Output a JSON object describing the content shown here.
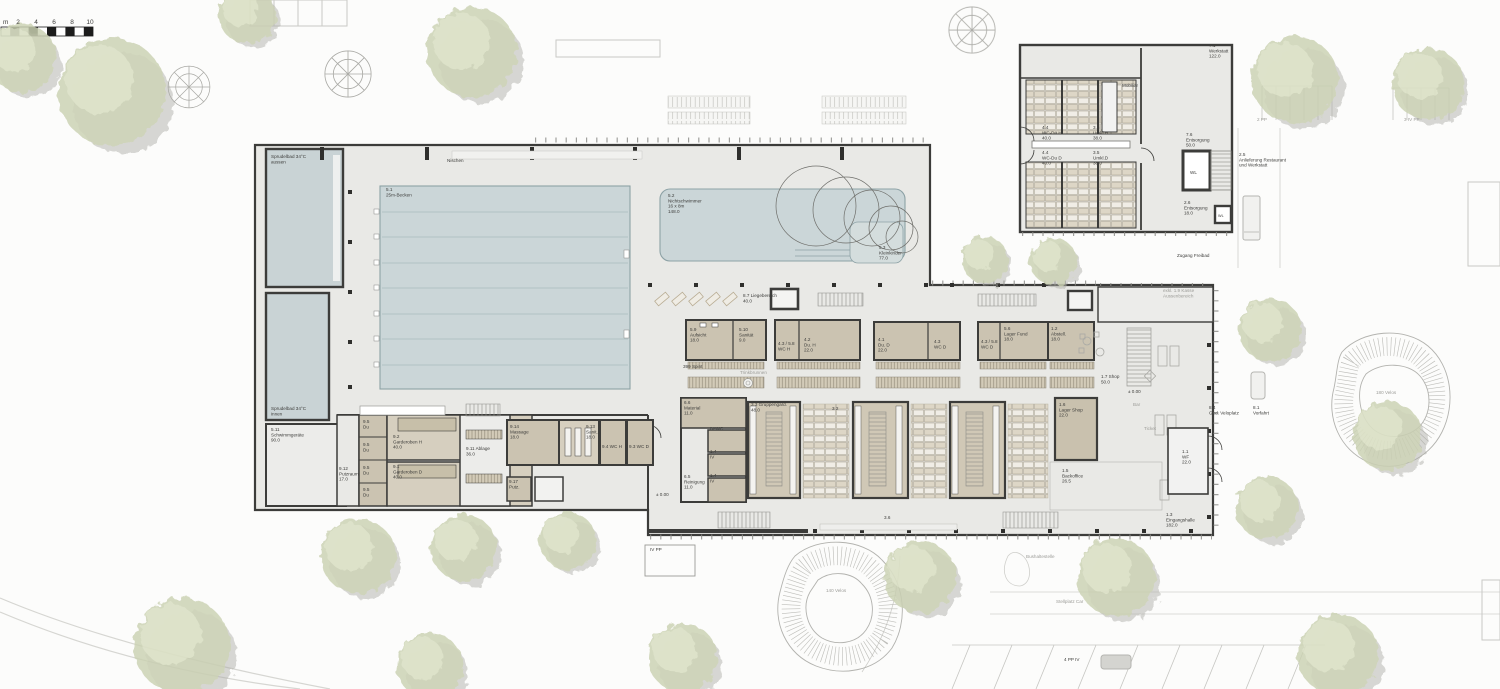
{
  "colors": {
    "dark": "#3d3d3b",
    "gray": "#9c9c98"
  },
  "scalebar": {
    "unit": "m",
    "ticks": [
      "2",
      "4",
      "6",
      "8",
      "10"
    ]
  },
  "labels": [
    {
      "id": "scale-unit",
      "x": 3,
      "y": 24,
      "s": 6.5,
      "lines": [
        "m"
      ]
    },
    {
      "id": "scale-2",
      "x": 18,
      "y": 24,
      "s": 6.5,
      "a": "middle",
      "lines": [
        "2"
      ]
    },
    {
      "id": "scale-4",
      "x": 36,
      "y": 24,
      "s": 6.5,
      "a": "middle",
      "lines": [
        "4"
      ]
    },
    {
      "id": "scale-6",
      "x": 54,
      "y": 24,
      "s": 6.5,
      "a": "middle",
      "lines": [
        "6"
      ]
    },
    {
      "id": "scale-8",
      "x": 72,
      "y": 24,
      "s": 6.5,
      "a": "middle",
      "lines": [
        "8"
      ]
    },
    {
      "id": "scale-10",
      "x": 90,
      "y": 24,
      "s": 6.5,
      "a": "middle",
      "lines": [
        "10"
      ]
    },
    {
      "id": "sprudelbad-aussen",
      "x": 271,
      "y": 158,
      "lines": [
        "Sprudelbad 34°C",
        "aussen"
      ]
    },
    {
      "id": "nischen",
      "x": 447,
      "y": 162,
      "lines": [
        "Nischen"
      ]
    },
    {
      "id": "becken-25m",
      "x": 386,
      "y": 191,
      "lines": [
        "5.1",
        "25m-Becken"
      ]
    },
    {
      "id": "nichtschwimmer",
      "x": 668,
      "y": 197,
      "lines": [
        "5.2",
        "Nichtschwimmer",
        "16 x 8m",
        "148.0"
      ]
    },
    {
      "id": "kleinkinder",
      "x": 879,
      "y": 249,
      "lines": [
        "5.3",
        "Kleinkinder",
        "77.0"
      ]
    },
    {
      "id": "sprudelbad-innen",
      "x": 271,
      "y": 410,
      "lines": [
        "Sprudelbad 34°C",
        "innen"
      ]
    },
    {
      "id": "schwimmgeraete",
      "x": 271,
      "y": 431,
      "lines": [
        "5.11",
        "Schwimmgeräte",
        "90.0"
      ]
    },
    {
      "id": "liegebereich",
      "x": 743,
      "y": 297,
      "lines": [
        "8.7 Liegebereich",
        "40.0"
      ]
    },
    {
      "id": "aufsicht",
      "x": 690,
      "y": 331,
      "lines": [
        "5.9",
        "Aufsicht",
        "18.0"
      ]
    },
    {
      "id": "sanitaet",
      "x": 739,
      "y": 331,
      "lines": [
        "5.10",
        "Sanität",
        "9.0"
      ]
    },
    {
      "id": "wc-h",
      "x": 778,
      "y": 345,
      "lines": [
        "4.3 / 5.8",
        "WC H"
      ]
    },
    {
      "id": "du-h",
      "x": 804,
      "y": 341,
      "lines": [
        "4.2",
        "Du. H",
        "22.0"
      ]
    },
    {
      "id": "spinde",
      "x": 683,
      "y": 368,
      "lines": [
        "399 Spint"
      ]
    },
    {
      "id": "trinkbrunnen",
      "x": 740,
      "y": 374,
      "c": "gray",
      "lines": [
        "Trinkbrunnen"
      ]
    },
    {
      "id": "du-d",
      "x": 878,
      "y": 341,
      "lines": [
        "4.1",
        "Du. D",
        "22.0"
      ]
    },
    {
      "id": "wc-d-a",
      "x": 934,
      "y": 343,
      "lines": [
        "4.3",
        "WC D"
      ]
    },
    {
      "id": "wc-d-b",
      "x": 981,
      "y": 343,
      "lines": [
        "4.3 / 5.8",
        "WC D"
      ]
    },
    {
      "id": "lager-fund",
      "x": 1004,
      "y": 330,
      "lines": [
        "5.6",
        "Lager Fund",
        "18.0"
      ]
    },
    {
      "id": "abstell",
      "x": 1051,
      "y": 330,
      "lines": [
        "1.2",
        "Abstell.",
        "18.0"
      ]
    },
    {
      "id": "material",
      "x": 684,
      "y": 404,
      "lines": [
        "6.6",
        "Material",
        "11.0"
      ]
    },
    {
      "id": "iv-wc",
      "x": 710,
      "y": 430,
      "lines": [
        "IV-WC"
      ]
    },
    {
      "id": "iv-1",
      "x": 710,
      "y": 453,
      "lines": [
        "1.4",
        "IV"
      ]
    },
    {
      "id": "iv-2",
      "x": 710,
      "y": 477,
      "lines": [
        "1.4",
        "IV"
      ]
    },
    {
      "id": "reinigung",
      "x": 684,
      "y": 478,
      "lines": [
        "6.5",
        "Reinigung",
        "11.0"
      ]
    },
    {
      "id": "gruppengard",
      "x": 751,
      "y": 406,
      "lines": [
        "3.3 Gruppengard.",
        "48.0"
      ]
    },
    {
      "id": "corridor-32",
      "x": 832,
      "y": 410,
      "lines": [
        "3.2"
      ]
    },
    {
      "id": "lager-shop",
      "x": 1059,
      "y": 406,
      "lines": [
        "1.6",
        "Lager Shop",
        "22.0"
      ]
    },
    {
      "id": "backoffice",
      "x": 1062,
      "y": 472,
      "lines": [
        "1.5",
        "Backoffice",
        "26.5"
      ]
    },
    {
      "id": "shop",
      "x": 1101,
      "y": 378,
      "lines": [
        "1.7 Shop",
        "50.0"
      ]
    },
    {
      "id": "level-entry",
      "x": 1128,
      "y": 393,
      "lines": [
        "± 0.00"
      ]
    },
    {
      "id": "bar",
      "x": 1133,
      "y": 406,
      "c": "gray",
      "lines": [
        "Bar"
      ]
    },
    {
      "id": "ticket",
      "x": 1144,
      "y": 430,
      "c": "gray",
      "lines": [
        "Ticket"
      ]
    },
    {
      "id": "wf",
      "x": 1182,
      "y": 453,
      "lines": [
        "1.1",
        "WF",
        "22.0"
      ]
    },
    {
      "id": "eingangshalle",
      "x": 1166,
      "y": 516,
      "lines": [
        "1.3",
        "Eingangshalle",
        "182.0"
      ]
    },
    {
      "id": "level-pool",
      "x": 656,
      "y": 496,
      "lines": [
        "± 0.00"
      ]
    },
    {
      "id": "putzraum",
      "x": 339,
      "y": 470,
      "lines": [
        "9.12",
        "Putzraum",
        "17.0"
      ]
    },
    {
      "id": "du-1",
      "x": 363,
      "y": 423,
      "lines": [
        "9.5",
        "Du"
      ]
    },
    {
      "id": "du-2",
      "x": 363,
      "y": 446,
      "lines": [
        "9.5",
        "Du"
      ]
    },
    {
      "id": "du-3",
      "x": 363,
      "y": 469,
      "lines": [
        "9.5",
        "Du"
      ]
    },
    {
      "id": "du-4",
      "x": 363,
      "y": 491,
      "lines": [
        "9.5",
        "Du"
      ]
    },
    {
      "id": "garderoben-h",
      "x": 393,
      "y": 438,
      "lines": [
        "9.2",
        "Garderoben H",
        "40.0"
      ]
    },
    {
      "id": "garderoben-d",
      "x": 393,
      "y": 468,
      "lines": [
        "9.1",
        "Garderoben D",
        "40.0"
      ]
    },
    {
      "id": "ablage",
      "x": 466,
      "y": 450,
      "lines": [
        "9.11 Ablage",
        "36.0"
      ]
    },
    {
      "id": "massage",
      "x": 510,
      "y": 428,
      "lines": [
        "9.14",
        "Massage",
        "18.0"
      ]
    },
    {
      "id": "raum-913",
      "x": 586,
      "y": 428,
      "lines": [
        "9.13",
        "Sanit.",
        "18.0"
      ]
    },
    {
      "id": "wc-h-9",
      "x": 602,
      "y": 448,
      "lines": [
        "9.4 WC H"
      ]
    },
    {
      "id": "wc-d-9",
      "x": 629,
      "y": 448,
      "lines": [
        "9.3 WC D"
      ]
    },
    {
      "id": "putz-klein",
      "x": 509,
      "y": 483,
      "lines": [
        "9.17",
        "Putz."
      ]
    },
    {
      "id": "werkstatt",
      "x": 1209,
      "y": 47,
      "lines": [
        "7.1",
        "Werkstatt",
        "122.0"
      ]
    },
    {
      "id": "mobiliar",
      "x": 1122,
      "y": 87,
      "lines": [
        "Mobiliar"
      ]
    },
    {
      "id": "wc-du-h",
      "x": 1042,
      "y": 129,
      "lines": [
        "4.4",
        "WC-Du H",
        "40.0"
      ]
    },
    {
      "id": "umkl-h",
      "x": 1093,
      "y": 129,
      "lines": [
        "3.5",
        "Umkl.H",
        "38.0"
      ]
    },
    {
      "id": "wc-du-d",
      "x": 1042,
      "y": 154,
      "lines": [
        "4.4",
        "WC-Du D",
        "40.0"
      ]
    },
    {
      "id": "umkl-d",
      "x": 1093,
      "y": 154,
      "lines": [
        "3.5",
        "Umkl.D",
        "38.0"
      ]
    },
    {
      "id": "entsorgung-76",
      "x": 1186,
      "y": 136,
      "lines": [
        "7.6",
        "Entsorgung",
        "50.0"
      ]
    },
    {
      "id": "wl-1",
      "x": 1190,
      "y": 174,
      "lines": [
        "WL"
      ]
    },
    {
      "id": "entsorgung-26",
      "x": 1184,
      "y": 204,
      "lines": [
        "2.6",
        "Entsorgung",
        "18.0"
      ]
    },
    {
      "id": "wl-2",
      "x": 1218,
      "y": 217,
      "s": 3.8,
      "lines": [
        "WL"
      ]
    },
    {
      "id": "anlieferung",
      "x": 1239,
      "y": 156,
      "lines": [
        "2.5",
        "Anlieferung Restaurant",
        "und Werkstatt"
      ]
    },
    {
      "id": "zugang-freibad",
      "x": 1177,
      "y": 257,
      "lines": [
        "Zugang Freibad"
      ]
    },
    {
      "id": "kasse",
      "x": 1163,
      "y": 292,
      "c": "gray",
      "lines": [
        "exkl. 1.9 Kasse",
        "Aussenbereich"
      ]
    },
    {
      "id": "pp-2",
      "x": 1257,
      "y": 121,
      "c": "gray",
      "lines": [
        "2 PP"
      ]
    },
    {
      "id": "pp-3iv",
      "x": 1404,
      "y": 121,
      "c": "gray",
      "lines": [
        "3 IV PP"
      ]
    },
    {
      "id": "ged-veloplatz",
      "x": 1209,
      "y": 409,
      "lines": [
        "8.4",
        "Ged. Veloplatz"
      ]
    },
    {
      "id": "vorfahrt",
      "x": 1253,
      "y": 409,
      "lines": [
        "8.1",
        "Vorfahrt"
      ]
    },
    {
      "id": "velos-140",
      "x": 826,
      "y": 592,
      "c": "gray",
      "lines": [
        "140 Velos"
      ]
    },
    {
      "id": "velos-180",
      "x": 1376,
      "y": 394,
      "c": "gray",
      "lines": [
        "180 Velos"
      ]
    },
    {
      "id": "stellplatz-car",
      "x": 1056,
      "y": 603,
      "c": "gray",
      "lines": [
        "Stellplatz Car"
      ]
    },
    {
      "id": "bushaltestelle",
      "x": 1026,
      "y": 558,
      "c": "gray",
      "lines": [
        "Bushaltestelle"
      ]
    },
    {
      "id": "iv-pp",
      "x": 650,
      "y": 551,
      "lines": [
        "IV PP"
      ]
    },
    {
      "id": "pp-4iv",
      "x": 1064,
      "y": 661,
      "lines": [
        "4 PP IV"
      ]
    },
    {
      "id": "facade-36",
      "x": 884,
      "y": 519,
      "lines": [
        "3.6"
      ]
    }
  ]
}
